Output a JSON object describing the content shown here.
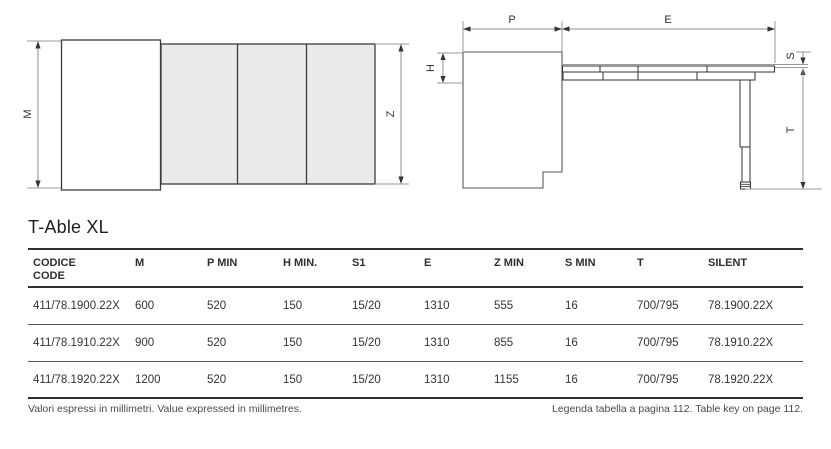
{
  "page": {
    "title": "T-Able XL"
  },
  "diagram_labels": {
    "m": "M",
    "z": "Z",
    "p": "P",
    "e": "E",
    "h": "H",
    "s": "S",
    "t": "T"
  },
  "colors": {
    "panel_fill": "#e9eaec",
    "outline": "#3c3c3c",
    "dim_line": "#8f8f8f",
    "arrow": "#333333"
  },
  "table": {
    "columns": [
      {
        "label": "CODICE",
        "sublabel": "CODE"
      },
      {
        "label": "M",
        "sublabel": ""
      },
      {
        "label": "P MIN",
        "sublabel": ""
      },
      {
        "label": "H MIN.",
        "sublabel": ""
      },
      {
        "label": "S1",
        "sublabel": ""
      },
      {
        "label": "E",
        "sublabel": ""
      },
      {
        "label": "Z MIN",
        "sublabel": ""
      },
      {
        "label": "S MIN",
        "sublabel": ""
      },
      {
        "label": "T",
        "sublabel": ""
      },
      {
        "label": "SILENT",
        "sublabel": ""
      }
    ],
    "rows": [
      [
        "411/78.1900.22X",
        "600",
        "520",
        "150",
        "15/20",
        "1310",
        "555",
        "16",
        "700/795",
        "78.1900.22X"
      ],
      [
        "411/78.1910.22X",
        "900",
        "520",
        "150",
        "15/20",
        "1310",
        "855",
        "16",
        "700/795",
        "78.1910.22X"
      ],
      [
        "411/78.1920.22X",
        "1200",
        "520",
        "150",
        "15/20",
        "1310",
        "1155",
        "16",
        "700/795",
        "78.1920.22X"
      ]
    ]
  },
  "footer": {
    "left": "Valori espressi in millimetri.  Value expressed in millimetres.",
    "right": "Legenda tabella a pagina 112.  Table key on page 112."
  }
}
